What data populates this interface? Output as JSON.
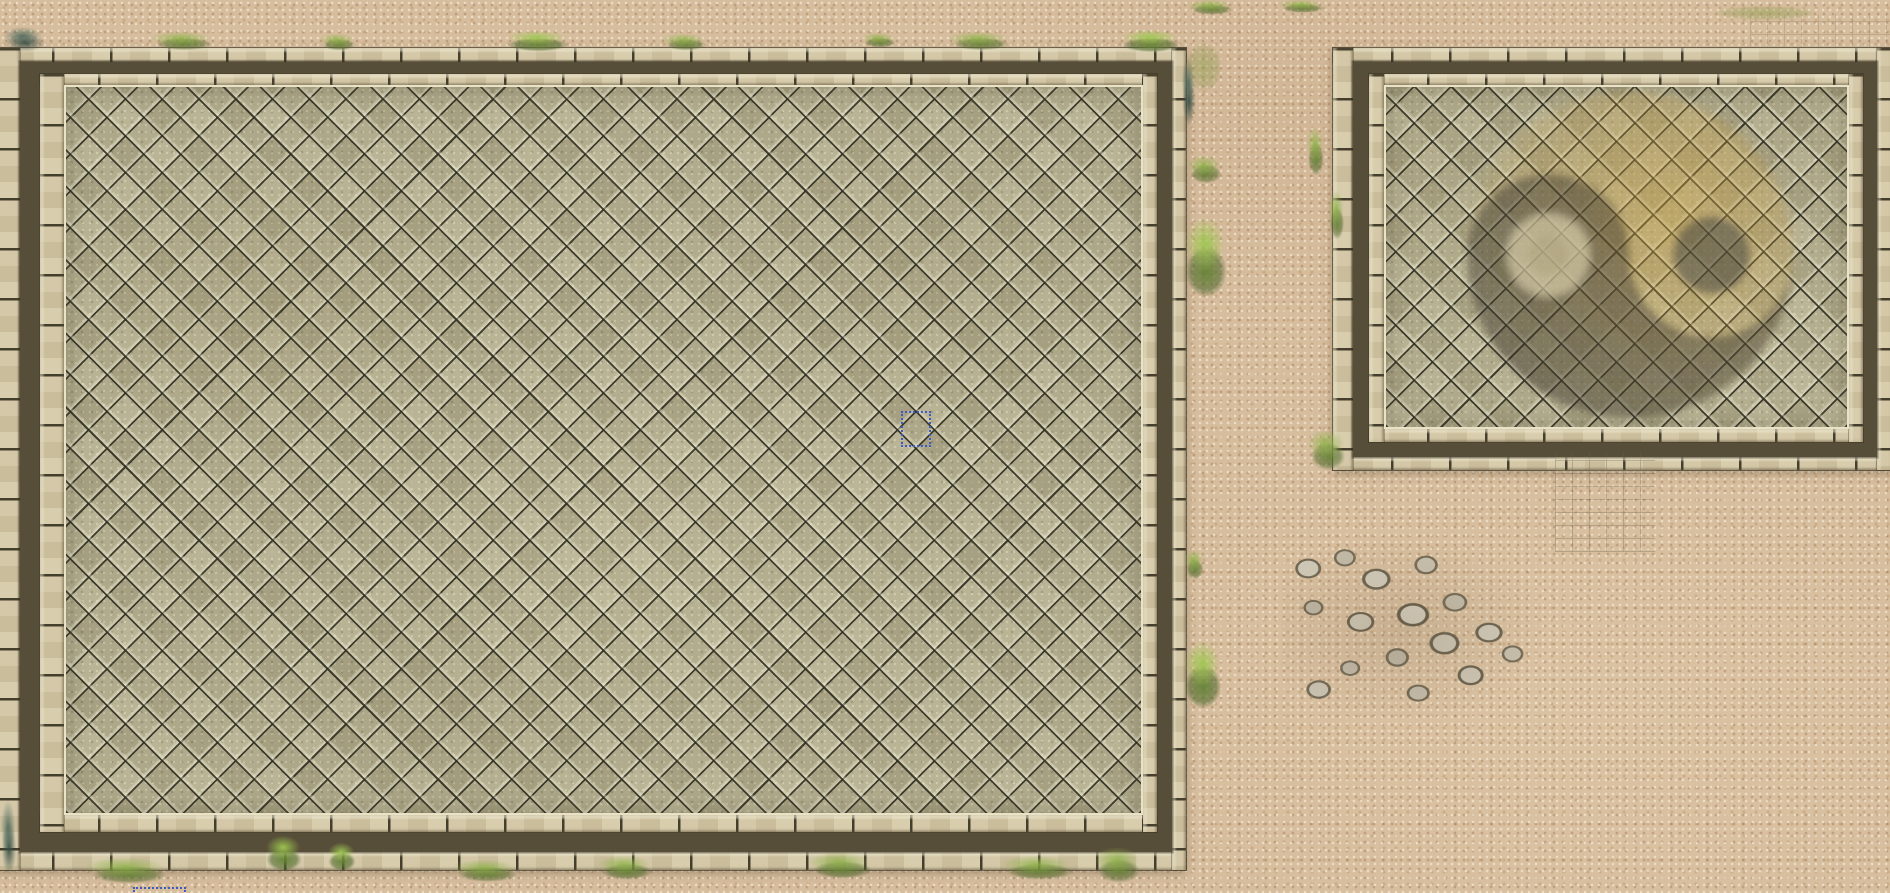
{
  "scene": {
    "description": "Top-down fantasy battlemap: two tiled sparring courtyards on sand, right one bearing a faded yin-yang mosaic, with grass tufts, rubble pile, brick debris and two editor selection marquees",
    "canvas": {
      "left": 0,
      "top": 0,
      "width": 1890,
      "height": 893
    },
    "colors": {
      "sand": "#d6bd9d",
      "tile": "#b2ac8e",
      "brick": "#cfc3a3",
      "band": "#574e39",
      "grass": "#6c8c38",
      "sel": "#3d5bc4",
      "yin": "#3a352c",
      "yang": "#c8a245",
      "stone": "#c4bcab"
    },
    "left_courtyard": {
      "box": {
        "left": -6,
        "top": 48,
        "width": 1192,
        "height": 822
      }
    },
    "right_courtyard": {
      "box": {
        "left": 1333,
        "top": 48,
        "width": 560,
        "height": 422
      }
    },
    "yin_yang": {
      "box": {
        "left": 1462,
        "top": 88,
        "width": 340,
        "height": 340
      },
      "center_x": 1630,
      "center_y": 255,
      "radius": 163,
      "light_dot": {
        "x": 1548,
        "y": 255,
        "r": 41
      },
      "dark_dot": {
        "x": 1712,
        "y": 255,
        "r": 39
      }
    },
    "rubble": {
      "box": {
        "left": 1282,
        "top": 540,
        "width": 262,
        "height": 178
      }
    },
    "debris_south": {
      "box": {
        "left": 1555,
        "top": 452,
        "width": 100,
        "height": 100
      }
    },
    "debris_ne": {
      "box": {
        "left": 1750,
        "top": 14,
        "width": 140,
        "height": 34
      }
    },
    "grass_strip_top": {
      "box": {
        "left": 0,
        "top": 30,
        "width": 1186,
        "height": 22
      }
    },
    "grass_strip_bottom": {
      "box": {
        "left": 0,
        "top": 862,
        "width": 1186,
        "height": 28
      }
    },
    "shade_top_band": {
      "box": {
        "left": 0,
        "top": 0,
        "width": 1890,
        "height": 34
      }
    },
    "shade_gap_light": {
      "box": {
        "left": 1186,
        "top": 0,
        "width": 146,
        "height": 480
      }
    },
    "shade_south_dark": {
      "box": {
        "left": 1200,
        "top": 470,
        "width": 520,
        "height": 300
      }
    },
    "shade_east_light": {
      "box": {
        "left": 1560,
        "top": 600,
        "width": 340,
        "height": 290
      }
    },
    "selections": [
      {
        "box": {
          "left": 901,
          "top": 411,
          "width": 26,
          "height": 32
        }
      },
      {
        "box": {
          "left": 133,
          "top": 887,
          "width": 49,
          "height": 12
        }
      }
    ],
    "grass": [
      {
        "box": {
          "left": 0,
          "top": 26,
          "width": 50,
          "height": 28
        },
        "kind": "teal"
      },
      {
        "box": {
          "left": 148,
          "top": 32,
          "width": 72,
          "height": 20
        },
        "kind": "norm"
      },
      {
        "box": {
          "left": 318,
          "top": 34,
          "width": 42,
          "height": 18
        },
        "kind": "norm"
      },
      {
        "box": {
          "left": 500,
          "top": 31,
          "width": 76,
          "height": 22
        },
        "kind": "bright"
      },
      {
        "box": {
          "left": 660,
          "top": 34,
          "width": 52,
          "height": 18
        },
        "kind": "norm"
      },
      {
        "box": {
          "left": 860,
          "top": 33,
          "width": 40,
          "height": 16
        },
        "kind": "norm"
      },
      {
        "box": {
          "left": 945,
          "top": 32,
          "width": 72,
          "height": 20
        },
        "kind": "norm"
      },
      {
        "box": {
          "left": 1115,
          "top": 30,
          "width": 72,
          "height": 24
        },
        "kind": "bright"
      },
      {
        "box": {
          "left": 1185,
          "top": 0,
          "width": 54,
          "height": 16
        },
        "kind": "norm"
      },
      {
        "box": {
          "left": 1276,
          "top": 0,
          "width": 54,
          "height": 14
        },
        "kind": "norm"
      },
      {
        "box": {
          "left": 1181,
          "top": 36,
          "width": 46,
          "height": 62
        },
        "kind": "moss"
      },
      {
        "box": {
          "left": 1181,
          "top": 56,
          "width": 16,
          "height": 76
        },
        "kind": "teal"
      },
      {
        "box": {
          "left": 1186,
          "top": 156,
          "width": 40,
          "height": 30
        },
        "kind": "norm"
      },
      {
        "box": {
          "left": 1180,
          "top": 218,
          "width": 52,
          "height": 86
        },
        "kind": "bright"
      },
      {
        "box": {
          "left": 1184,
          "top": 550,
          "width": 22,
          "height": 32
        },
        "kind": "norm"
      },
      {
        "box": {
          "left": 1180,
          "top": 642,
          "width": 46,
          "height": 72
        },
        "kind": "bright"
      },
      {
        "box": {
          "left": 1306,
          "top": 128,
          "width": 20,
          "height": 52
        },
        "kind": "norm"
      },
      {
        "box": {
          "left": 1328,
          "top": 192,
          "width": 18,
          "height": 52
        },
        "kind": "norm"
      },
      {
        "box": {
          "left": 1306,
          "top": 430,
          "width": 44,
          "height": 44
        },
        "kind": "norm"
      },
      {
        "box": {
          "left": 0,
          "top": 798,
          "width": 18,
          "height": 84
        },
        "kind": "teal"
      },
      {
        "box": {
          "left": 82,
          "top": 858,
          "width": 95,
          "height": 28
        },
        "kind": "norm"
      },
      {
        "box": {
          "left": 262,
          "top": 836,
          "width": 44,
          "height": 38
        },
        "kind": "bright"
      },
      {
        "box": {
          "left": 325,
          "top": 843,
          "width": 34,
          "height": 30
        },
        "kind": "bright"
      },
      {
        "box": {
          "left": 450,
          "top": 860,
          "width": 75,
          "height": 24
        },
        "kind": "norm"
      },
      {
        "box": {
          "left": 595,
          "top": 856,
          "width": 64,
          "height": 26
        },
        "kind": "norm"
      },
      {
        "box": {
          "left": 805,
          "top": 853,
          "width": 75,
          "height": 28
        },
        "kind": "norm"
      },
      {
        "box": {
          "left": 998,
          "top": 856,
          "width": 84,
          "height": 26
        },
        "kind": "norm"
      },
      {
        "box": {
          "left": 1092,
          "top": 848,
          "width": 54,
          "height": 38
        },
        "kind": "norm"
      },
      {
        "box": {
          "left": 1700,
          "top": 4,
          "width": 130,
          "height": 18
        },
        "kind": "moss"
      }
    ]
  }
}
